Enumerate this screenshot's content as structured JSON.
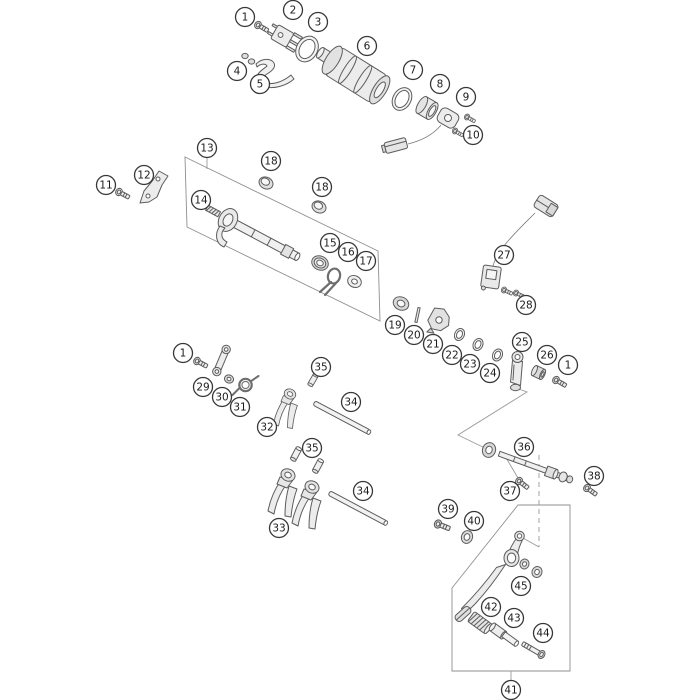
{
  "diagram": {
    "background": "#ffffff",
    "part_line_color": "#5c5c5c",
    "callout_style": {
      "radius": 9.5,
      "fill": "#ffffff",
      "stroke": "#383838",
      "text_color": "#1c1c1c",
      "font_size": 10.5
    },
    "callouts": [
      {
        "name": "callout-1-top",
        "label": "1",
        "x": 245,
        "y": 17
      },
      {
        "name": "callout-2",
        "label": "2",
        "x": 293,
        "y": 10
      },
      {
        "name": "callout-3",
        "label": "3",
        "x": 318,
        "y": 22
      },
      {
        "name": "callout-4",
        "label": "4",
        "x": 237,
        "y": 71
      },
      {
        "name": "callout-5",
        "label": "5",
        "x": 260,
        "y": 84
      },
      {
        "name": "callout-6",
        "label": "6",
        "x": 367,
        "y": 46
      },
      {
        "name": "callout-7",
        "label": "7",
        "x": 413,
        "y": 70
      },
      {
        "name": "callout-8",
        "label": "8",
        "x": 440,
        "y": 84
      },
      {
        "name": "callout-9",
        "label": "9",
        "x": 466,
        "y": 97
      },
      {
        "name": "callout-10",
        "label": "10",
        "x": 473,
        "y": 135
      },
      {
        "name": "callout-11",
        "label": "11",
        "x": 106,
        "y": 185
      },
      {
        "name": "callout-12",
        "label": "12",
        "x": 144,
        "y": 175
      },
      {
        "name": "callout-13",
        "label": "13",
        "x": 207,
        "y": 148
      },
      {
        "name": "callout-14",
        "label": "14",
        "x": 201,
        "y": 200
      },
      {
        "name": "callout-18-left",
        "label": "18",
        "x": 271,
        "y": 161
      },
      {
        "name": "callout-18-right",
        "label": "18",
        "x": 322,
        "y": 187
      },
      {
        "name": "callout-15",
        "label": "15",
        "x": 330,
        "y": 243
      },
      {
        "name": "callout-16",
        "label": "16",
        "x": 348,
        "y": 252
      },
      {
        "name": "callout-17",
        "label": "17",
        "x": 366,
        "y": 261
      },
      {
        "name": "callout-19",
        "label": "19",
        "x": 395,
        "y": 325
      },
      {
        "name": "callout-20",
        "label": "20",
        "x": 414,
        "y": 335
      },
      {
        "name": "callout-21",
        "label": "21",
        "x": 433,
        "y": 344
      },
      {
        "name": "callout-22",
        "label": "22",
        "x": 452,
        "y": 355
      },
      {
        "name": "callout-23",
        "label": "23",
        "x": 470,
        "y": 364
      },
      {
        "name": "callout-24",
        "label": "24",
        "x": 490,
        "y": 373
      },
      {
        "name": "callout-25",
        "label": "25",
        "x": 522,
        "y": 342
      },
      {
        "name": "callout-26",
        "label": "26",
        "x": 547,
        "y": 355
      },
      {
        "name": "callout-1-mid",
        "label": "1",
        "x": 568,
        "y": 365
      },
      {
        "name": "callout-27",
        "label": "27",
        "x": 504,
        "y": 255
      },
      {
        "name": "callout-28",
        "label": "28",
        "x": 526,
        "y": 305
      },
      {
        "name": "callout-1-lower",
        "label": "1",
        "x": 183,
        "y": 353
      },
      {
        "name": "callout-29",
        "label": "29",
        "x": 203,
        "y": 387
      },
      {
        "name": "callout-30",
        "label": "30",
        "x": 222,
        "y": 397
      },
      {
        "name": "callout-31",
        "label": "31",
        "x": 240,
        "y": 407
      },
      {
        "name": "callout-32",
        "label": "32",
        "x": 267,
        "y": 427
      },
      {
        "name": "callout-35-upper",
        "label": "35",
        "x": 321,
        "y": 367
      },
      {
        "name": "callout-34-upper",
        "label": "34",
        "x": 351,
        "y": 402
      },
      {
        "name": "callout-35-lower",
        "label": "35",
        "x": 312,
        "y": 448
      },
      {
        "name": "callout-33",
        "label": "33",
        "x": 279,
        "y": 528
      },
      {
        "name": "callout-34-lower",
        "label": "34",
        "x": 363,
        "y": 491
      },
      {
        "name": "callout-36",
        "label": "36",
        "x": 524,
        "y": 447
      },
      {
        "name": "callout-37",
        "label": "37",
        "x": 510,
        "y": 491
      },
      {
        "name": "callout-38",
        "label": "38",
        "x": 594,
        "y": 476
      },
      {
        "name": "callout-39",
        "label": "39",
        "x": 448,
        "y": 509
      },
      {
        "name": "callout-40",
        "label": "40",
        "x": 474,
        "y": 521
      },
      {
        "name": "callout-45",
        "label": "45",
        "x": 521,
        "y": 586
      },
      {
        "name": "callout-42",
        "label": "42",
        "x": 491,
        "y": 607
      },
      {
        "name": "callout-43",
        "label": "43",
        "x": 514,
        "y": 618
      },
      {
        "name": "callout-44",
        "label": "44",
        "x": 543,
        "y": 633
      },
      {
        "name": "callout-41",
        "label": "41",
        "x": 511,
        "y": 690
      }
    ],
    "group_boxes": [
      {
        "name": "box-shift-shaft-assembly",
        "points": "185,157 378,251 380,321 187,227"
      },
      {
        "name": "box-shift-pedal-assembly",
        "points": "518,505 570,505 570,671 452,671 452,588"
      }
    ],
    "leader_lines": [
      {
        "name": "leader-callout-13-to-box",
        "points": "207,158 207,169",
        "dashed": false
      },
      {
        "name": "leader-callout-41-to-box",
        "points": "511,671 511,680",
        "dashed": false
      },
      {
        "name": "leader-lever-to-shaft",
        "points": "516,388 527,392 458,435 489,450",
        "dashed": false
      },
      {
        "name": "leader-shaft-to-bolt-37",
        "points": "505,456 518,478",
        "dashed": false
      },
      {
        "name": "leader-shaft-to-pedal",
        "points": "539,455 539,547",
        "dashed": true
      },
      {
        "name": "leader-shaft-to-pedal-tail",
        "points": "539,547 523,538",
        "dashed": false
      }
    ]
  }
}
